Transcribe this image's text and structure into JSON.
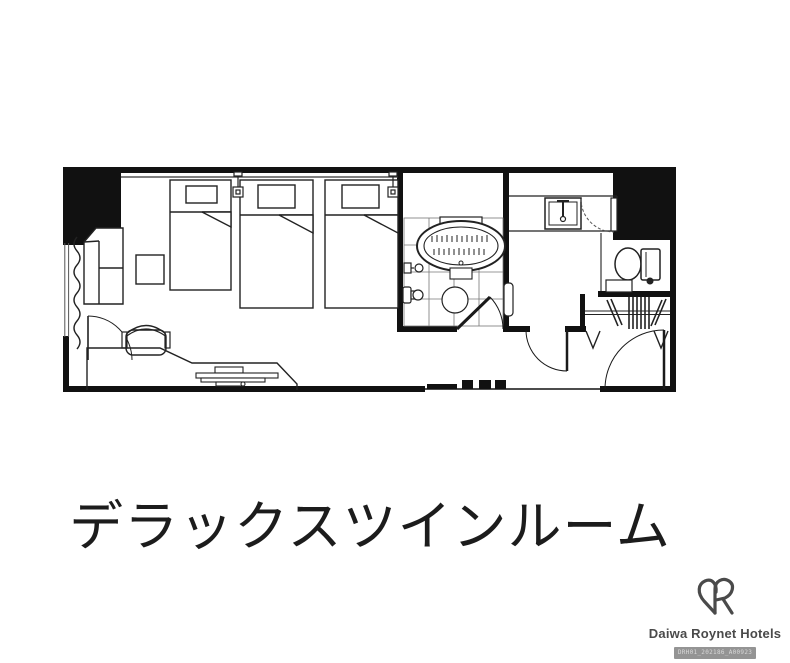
{
  "caption": {
    "title": "デラックスツインルーム"
  },
  "brand": {
    "logo_name": "Daiwa Roynet Hotels",
    "monogram": "DR",
    "stamp_text": "DRH01_202186_A00923",
    "text_color": "#4a4a4a"
  },
  "floor_plan": {
    "type": "hotel-room-floor-plan",
    "line_color": "#1a1a1a",
    "wall_color": "#111111",
    "elements": [
      "bed-1",
      "bed-2",
      "bed-3",
      "wall-lamp",
      "sofa",
      "side-table",
      "window-curtain",
      "desk-counter",
      "desk-chair",
      "tv",
      "mini-door",
      "bathtub",
      "shower-fixture",
      "bathroom-tile-floor",
      "floor-drain",
      "bathroom-door",
      "sink-vanity",
      "mirror-door",
      "toilet",
      "shelf",
      "closet-hangers",
      "closet-rod",
      "vestibule-door",
      "entry-door"
    ]
  }
}
